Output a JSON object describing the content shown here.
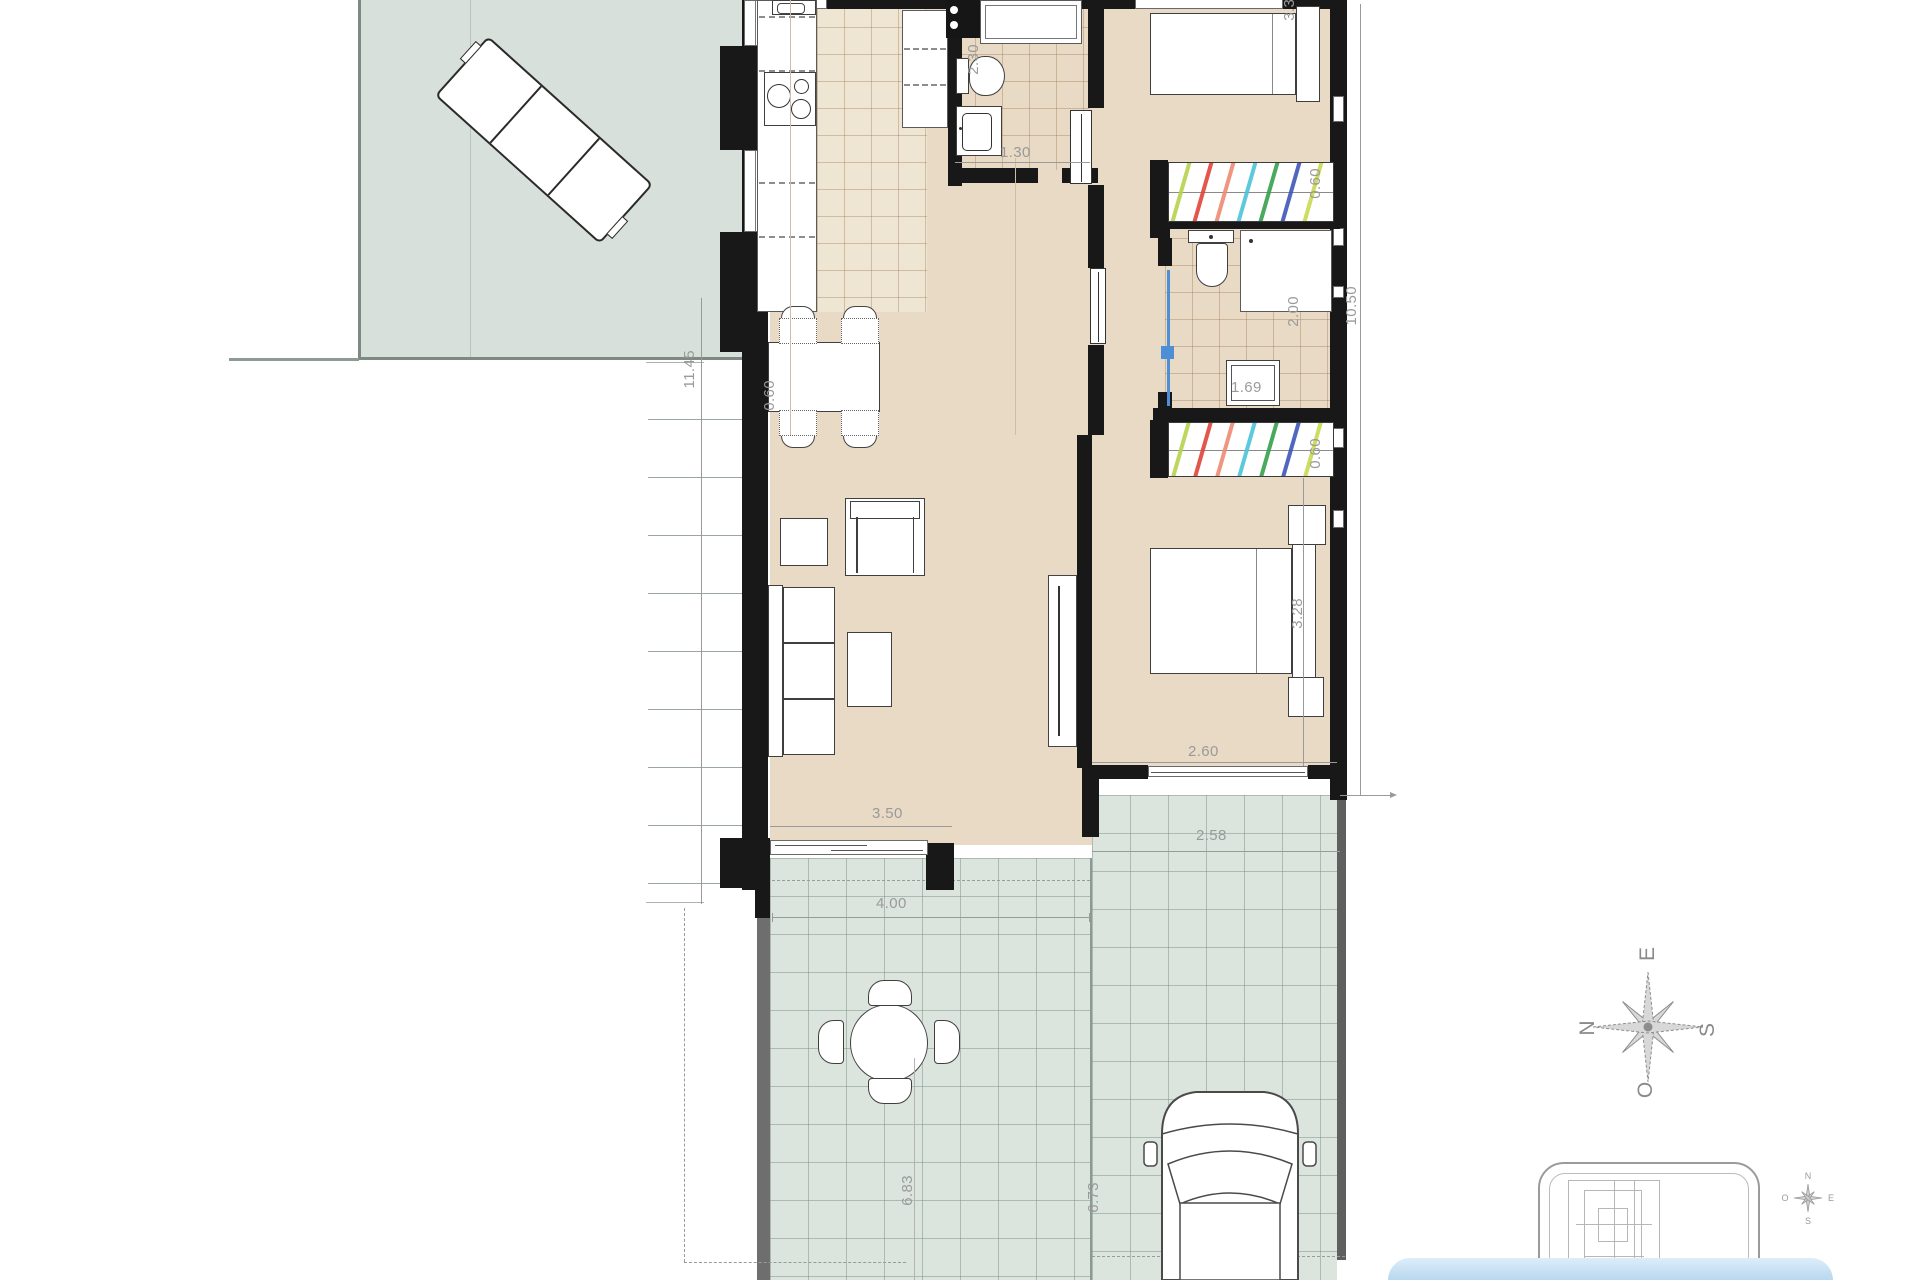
{
  "dims": {
    "d1145": "11.45",
    "d230": "2.30",
    "d130": "1.30",
    "d332": "3.32",
    "d060_wardrobe_top": "0.60",
    "d200": "2.00",
    "d1050": "10.50",
    "d169": "1.69",
    "d060_wardrobe_bottom": "0.60",
    "d060_dining": "0.60",
    "d328": "3.28",
    "d260": "2.60",
    "d350": "3.50",
    "d258": "2.58",
    "d400": "4.00",
    "d683": "6.83",
    "d673": "6.73"
  },
  "compass": {
    "top": "E",
    "left": "N",
    "right": "S",
    "bottom": "O"
  },
  "inset_compass": {
    "top": "N",
    "right": "E",
    "bottom": "S",
    "left": "O"
  },
  "colors": {
    "floor_beige": "#e8dac5",
    "kitchen_tile": "#efe5d3",
    "terrace_sage": "#dce4de",
    "upper_terrace": "#d7e0da",
    "wall_black": "#181818",
    "dim_text_gray": "#9a9a9a",
    "shower_screen_blue": "#4d8fd6",
    "water_blue": "#cfe4f4",
    "wardrobe_stripes": [
      "#b6d24b",
      "#e04438",
      "#ef8a76",
      "#4cc3d9",
      "#35a04a",
      "#3d55b8",
      "#c8d94e"
    ]
  }
}
